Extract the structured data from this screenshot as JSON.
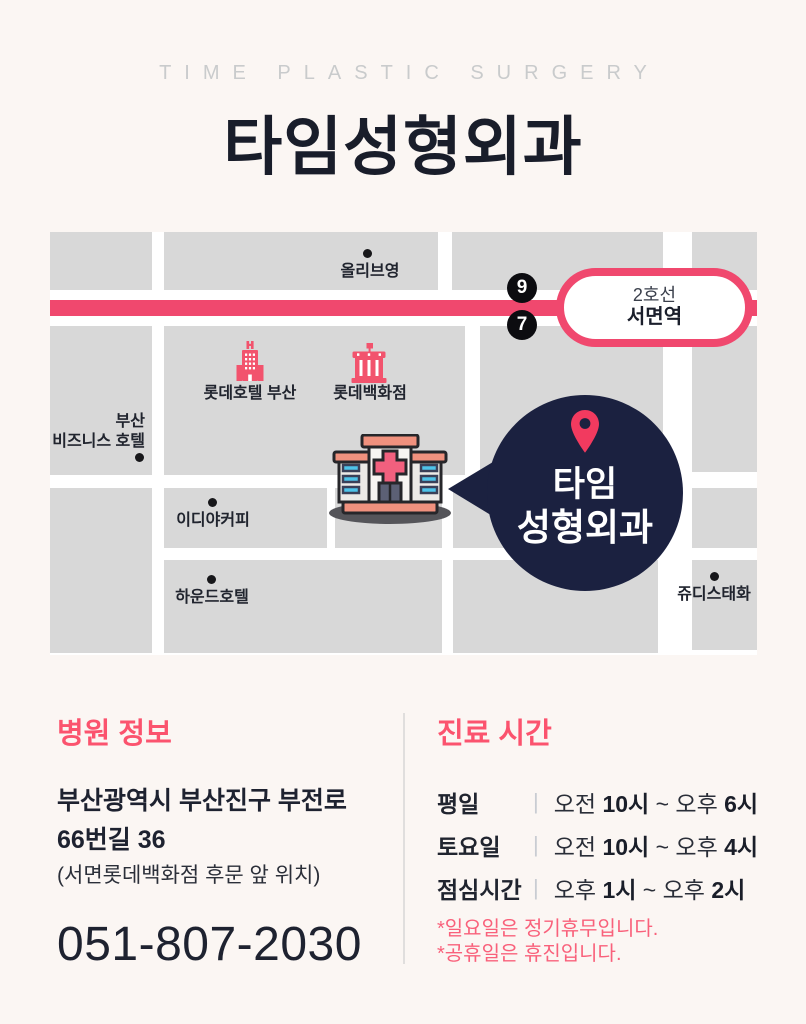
{
  "header": {
    "eyebrow": "TIME PLASTIC SURGERY",
    "title": "타임성형외과"
  },
  "map": {
    "station": {
      "line": "2호선",
      "name": "서면역"
    },
    "exits": {
      "top": "9",
      "bottom": "7"
    },
    "pois": {
      "oliveyoung": "올리브영",
      "busan_biz": "부산\n비즈니스 호텔",
      "lotte_hotel": "롯데호텔 부산",
      "lotte_dept": "롯데백화점",
      "ediya": "이디야커피",
      "hound": "하운드호텔",
      "judies": "쥬디스태화"
    },
    "bubble": {
      "line1": "타임",
      "line2": "성형외과"
    }
  },
  "info": {
    "heading": "병원 정보",
    "address_line1": "부산광역시 부산진구 부전로",
    "address_line2": "66번길 36",
    "address_note": "(서면롯데백화점 후문 앞 위치)",
    "phone": "051-807-2030"
  },
  "schedule": {
    "heading": "진료 시간",
    "separator": "|",
    "rows": [
      {
        "label": "평일",
        "t1": "오전 ",
        "b1": "10시",
        "t2": " ~ ",
        "t3": "오후 ",
        "b2": "6시"
      },
      {
        "label": "토요일",
        "t1": "오전 ",
        "b1": "10시",
        "t2": " ~ ",
        "t3": "오후 ",
        "b2": "4시"
      },
      {
        "label": "점심시간",
        "t1": "오후 ",
        "b1": "1시",
        "t2": " ~ ",
        "t3": "오후 ",
        "b2": "2시"
      }
    ],
    "notes": [
      "*일요일은 정기휴무입니다.",
      "*공휴일은 휴진입니다."
    ]
  },
  "colors": {
    "accent_pink": "#F0486E",
    "heading_pink": "#FB536E",
    "note_pink": "#F9617B",
    "navy_bubble": "#1B2140",
    "block_gray": "#D8D8D8",
    "page_bg": "#FBF6F3"
  }
}
